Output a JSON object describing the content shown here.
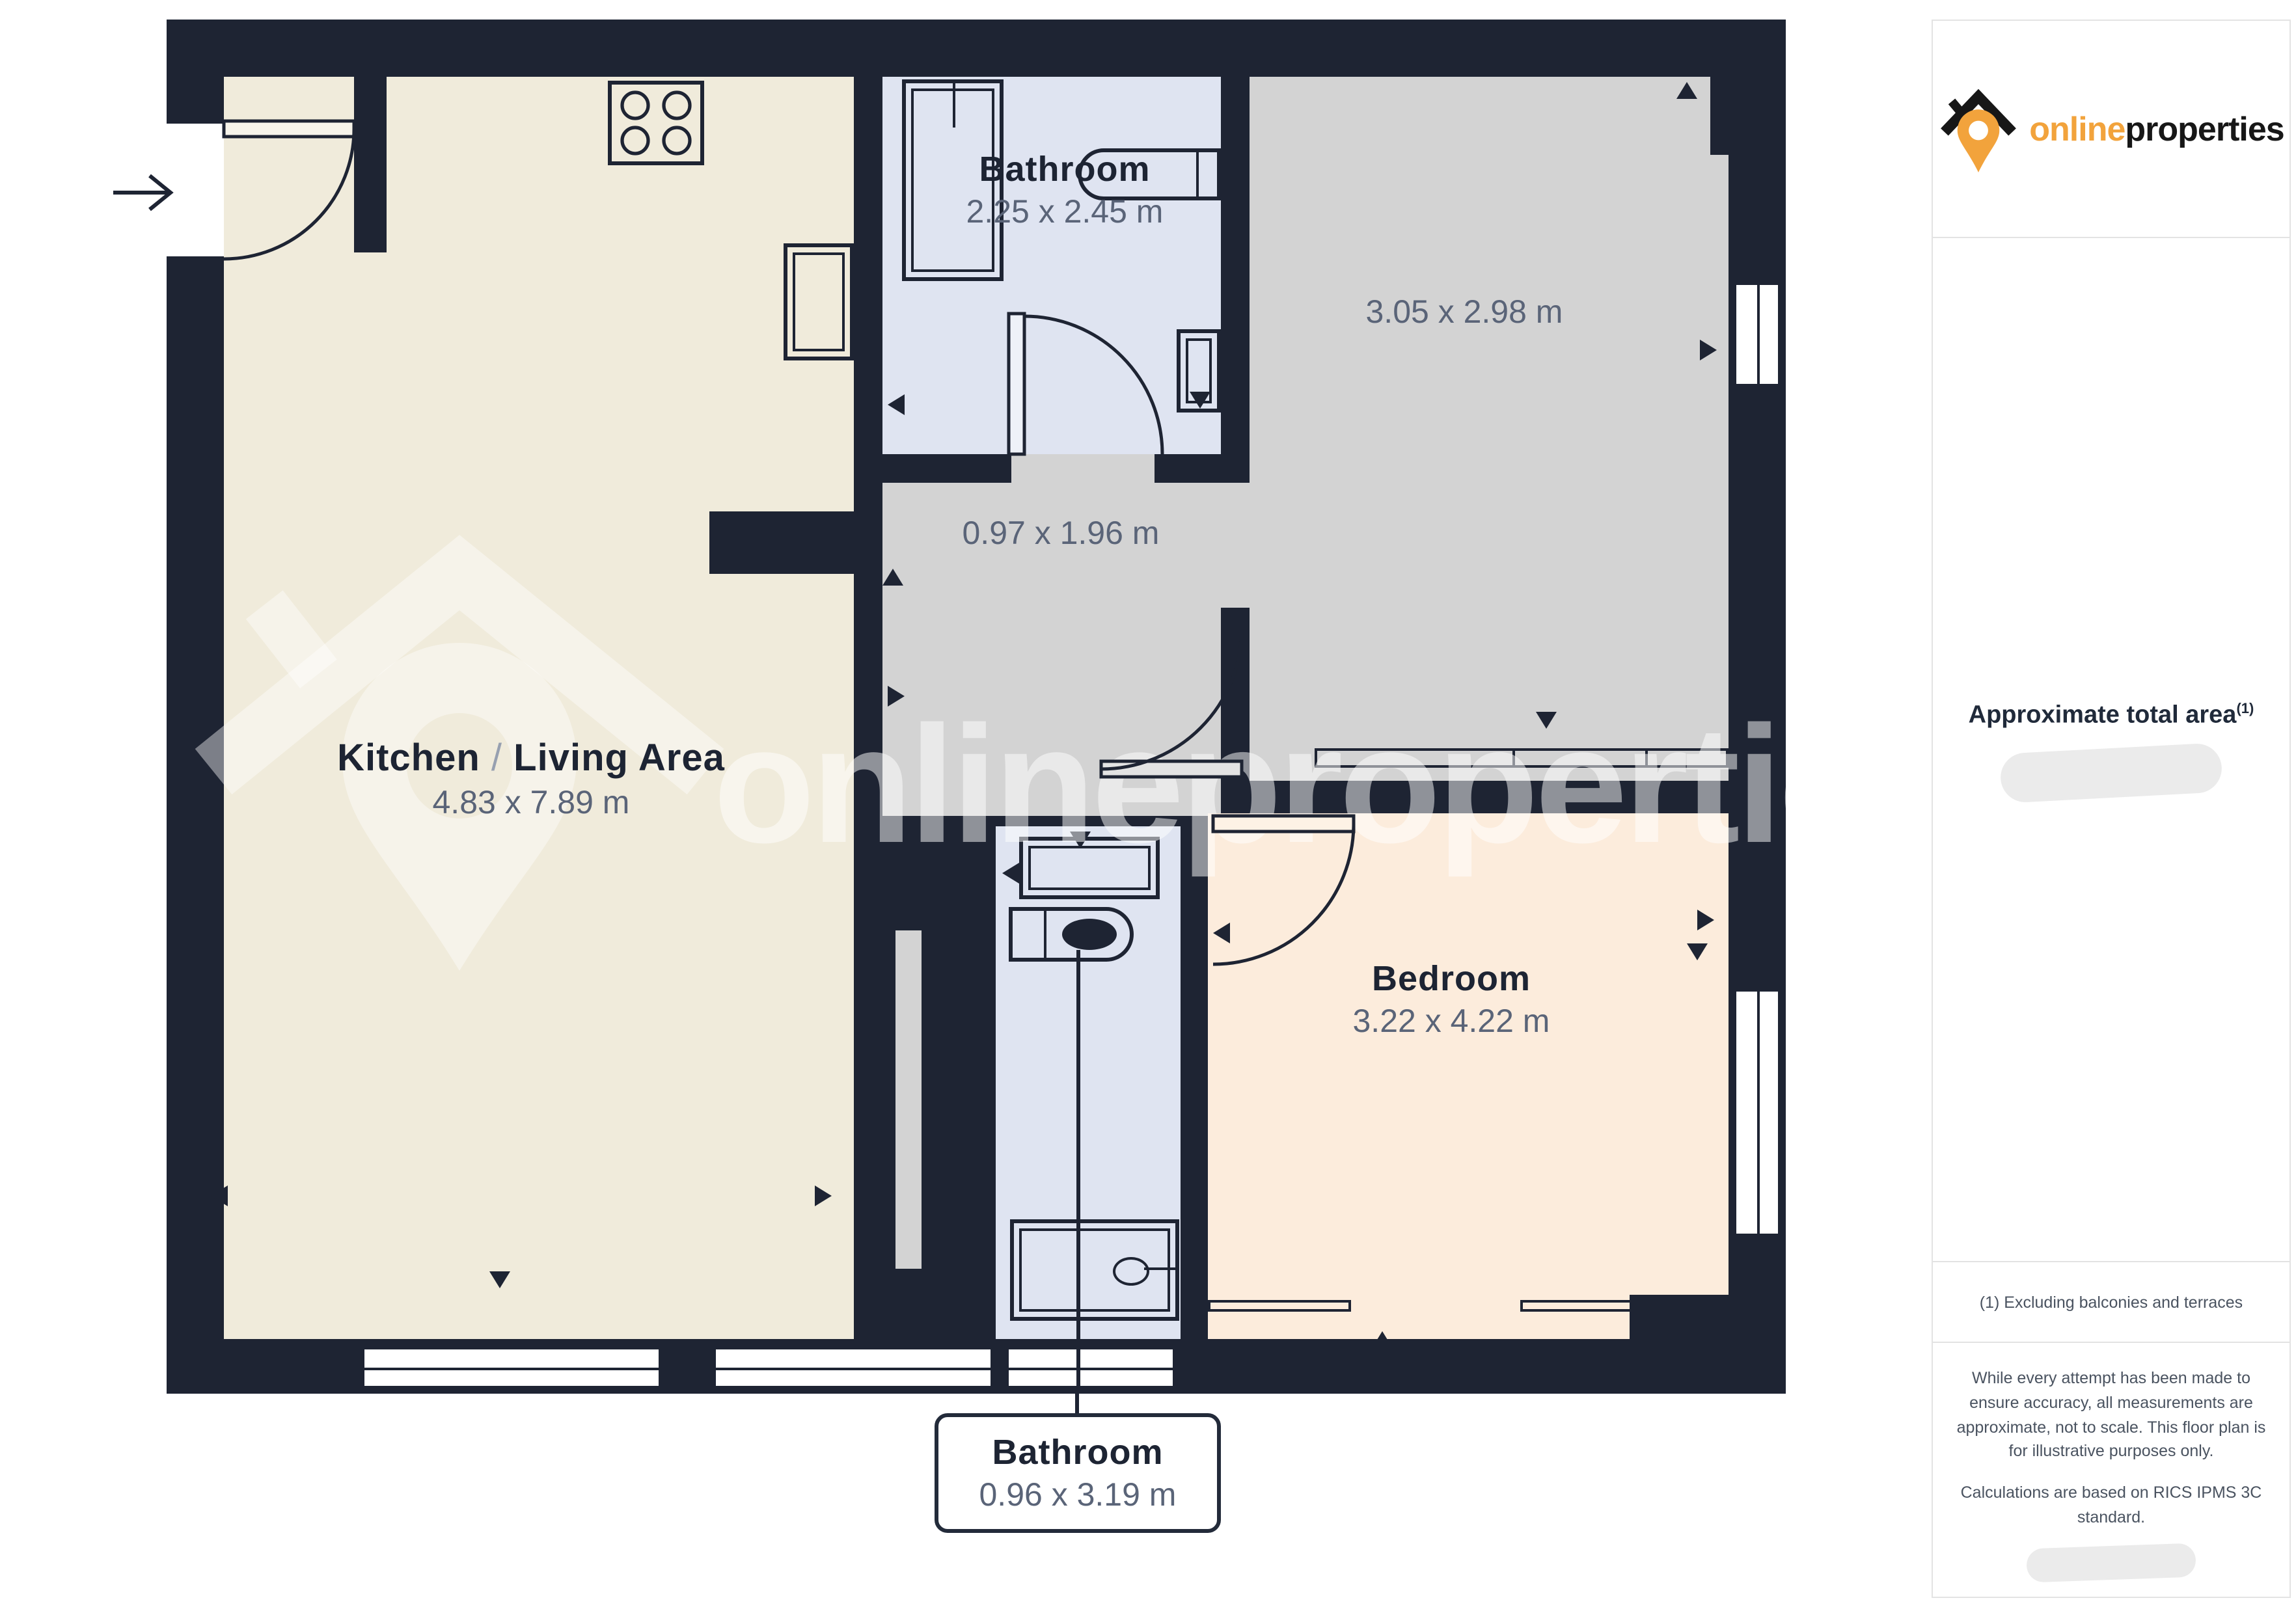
{
  "logo": {
    "brand_first": "online",
    "brand_second": "properties",
    "accent_color": "#f2a33c",
    "dark_color": "#171717"
  },
  "floor_plan": {
    "watermark_text": "onlineproperties",
    "colors": {
      "wall": "#1e2433",
      "kitchen_fill": "#f0ebdb",
      "bathroom_fill": "#dfe4f1",
      "neutral_room_fill": "#d3d3d3",
      "bedroom_fill": "#fcecdc"
    },
    "rooms": {
      "kitchen": {
        "name_1": "Kitchen",
        "name_sep": "/",
        "name_2": "Living Area",
        "dims": "4.83 x 7.89 m"
      },
      "bathroom_top": {
        "name": "Bathroom",
        "dims": "2.25 x 2.45 m"
      },
      "room_secondary": {
        "dims": "3.05 x 2.98 m"
      },
      "hallway": {
        "dims": "0.97 x 1.96 m"
      },
      "bedroom": {
        "name": "Bedroom",
        "dims": "3.22 x 4.22 m"
      },
      "bathroom_ensuite": {
        "name": "Bathroom",
        "dims": "0.96 x 3.19 m"
      }
    }
  },
  "sidebar": {
    "area_title": "Approximate total area",
    "area_superscript": "(1)",
    "footnote": "(1) Excluding balconies and terraces",
    "disclaimer_1": "While every attempt has been made to ensure accuracy, all measurements are approximate, not to scale. This floor plan is for illustrative purposes only.",
    "disclaimer_2": "Calculations are based on RICS IPMS 3C standard."
  }
}
